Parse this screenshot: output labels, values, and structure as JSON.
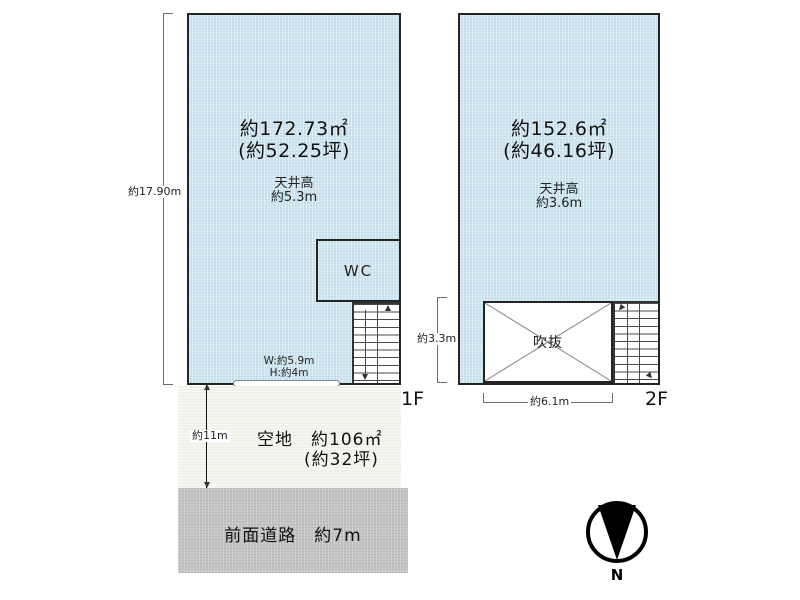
{
  "floor1": {
    "floor_label": "1F",
    "area": "約172.73㎡",
    "area_tsubo": "(約52.25坪)",
    "ceiling_label": "天井高",
    "ceiling_value": "約5.3m",
    "wc_label": "WC",
    "opening_width": "W:約5.9m",
    "opening_height": "H:約4m",
    "up_label": "UP",
    "dim_depth": "約17.90m",
    "dim_frontage": "約9.65m"
  },
  "floor2": {
    "floor_label": "2F",
    "area": "約152.6㎡",
    "area_tsubo": "(約46.16坪)",
    "ceiling_label": "天井高",
    "ceiling_value": "約3.6m",
    "void_label": "吹抜",
    "dim_void_width": "約6.1m",
    "dim_void_depth": "約3.3m"
  },
  "site": {
    "vacant_label": "空地　約106㎡",
    "vacant_tsubo": "(約32坪)",
    "vacant_depth": "約11m",
    "road_label": "前面道路　約7m"
  },
  "compass": {
    "north_label": "N"
  },
  "colors": {
    "plan_fill": "#cde4ee",
    "vacant_fill": "#f2f1e9",
    "road_fill": "#c3c3c4",
    "line": "#242424"
  }
}
